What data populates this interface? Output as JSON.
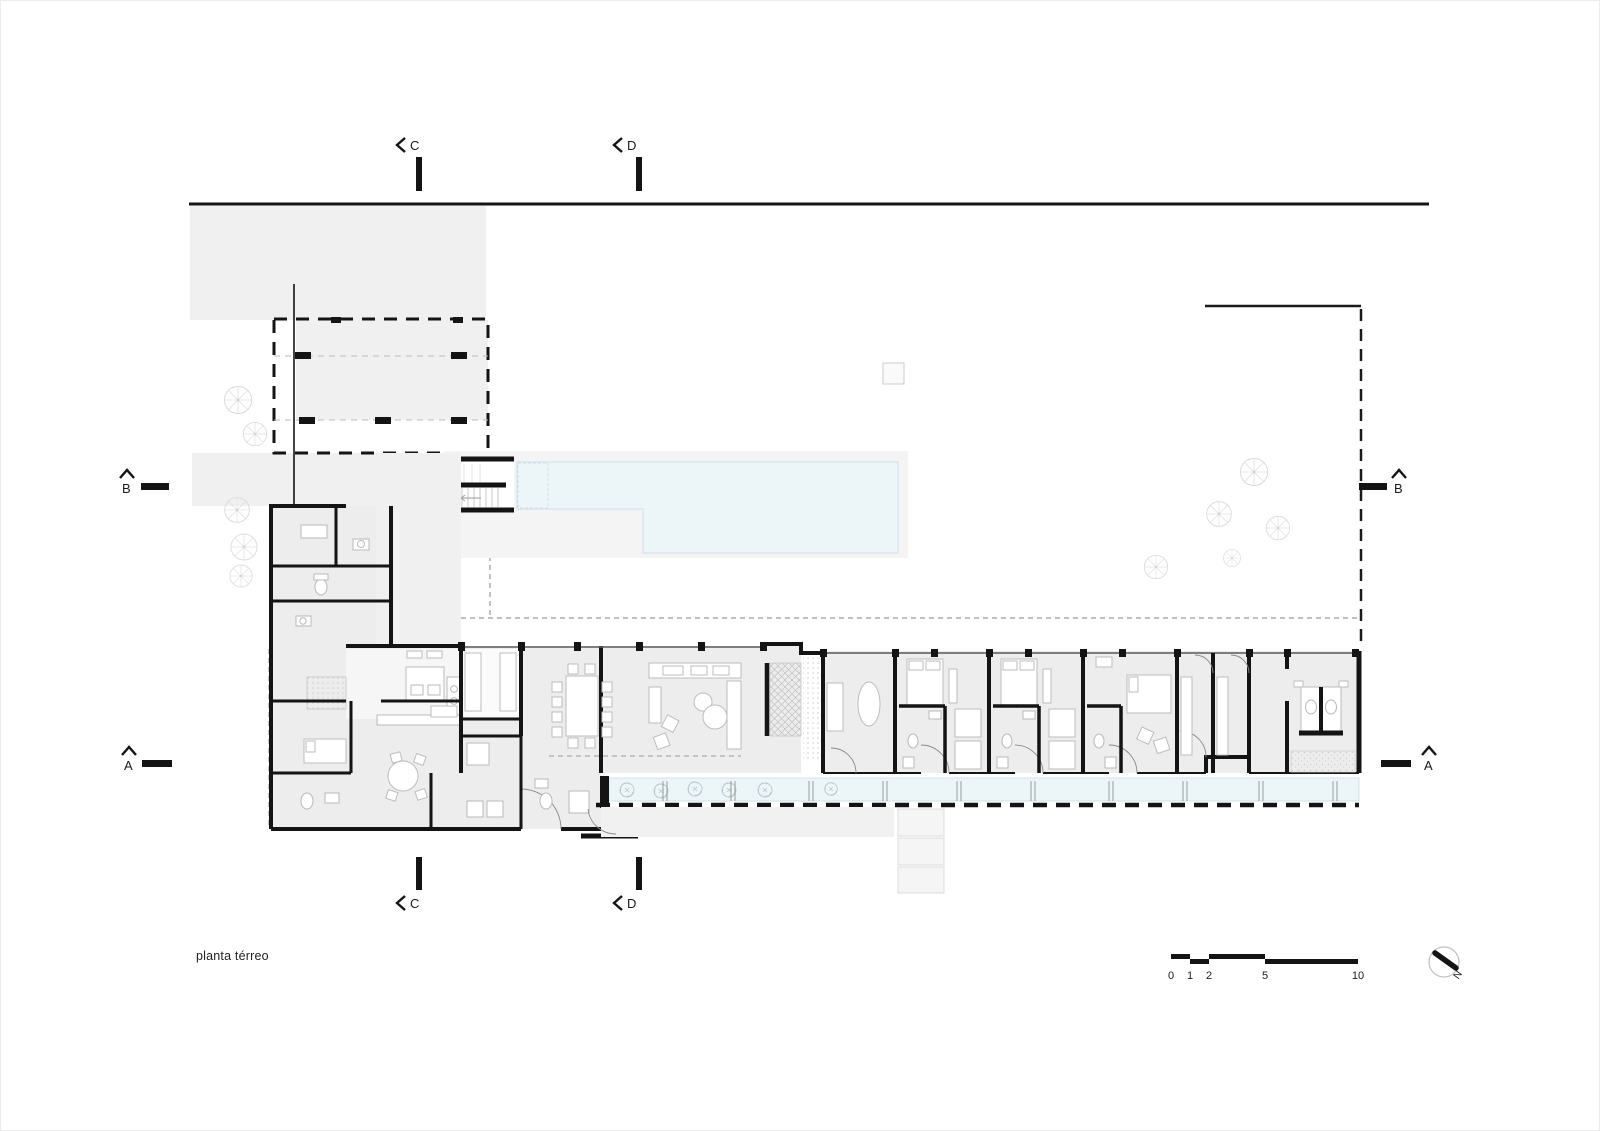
{
  "drawing": {
    "title": "planta térreo"
  },
  "section_markers": {
    "a": "A",
    "b": "B",
    "c": "C",
    "d": "D"
  },
  "scale_bar": {
    "ticks": [
      "0",
      "1",
      "2",
      "5",
      "10"
    ]
  },
  "north_arrow": {
    "label": "N"
  },
  "colors": {
    "wall": "#141414",
    "site_fill": "#f0f0f0",
    "floor_fill": "#ededed",
    "water_fill": "#ecf5f8",
    "furniture_line": "#c2c2c2",
    "tree_line": "#dcdcdc"
  }
}
